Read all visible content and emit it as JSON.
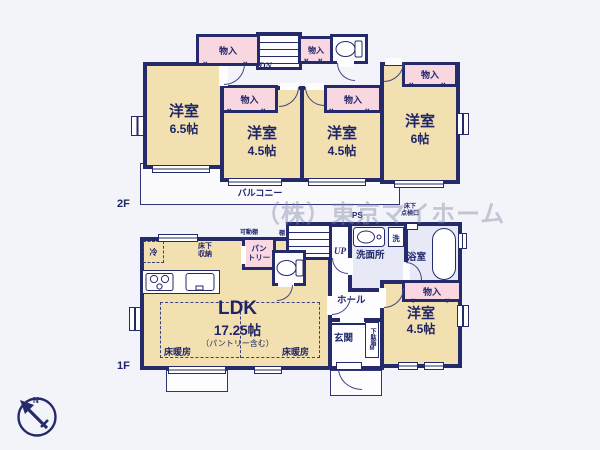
{
  "watermark": "（株）東京マイホーム",
  "compass": {
    "north": "N"
  },
  "icons": {
    "fold_mark": "∨"
  },
  "floor2": {
    "label": "2F",
    "balcony": "バルコニー",
    "stairs": "DN",
    "closet": "物入",
    "rooms": [
      {
        "name": "洋室",
        "size": "6.5帖"
      },
      {
        "name": "洋室",
        "size": "4.5帖"
      },
      {
        "name": "洋室",
        "size": "4.5帖"
      },
      {
        "name": "洋室",
        "size": "6帖"
      }
    ]
  },
  "floor1": {
    "label": "1F",
    "stairs": "UP",
    "ps": "PS",
    "closet": "物入",
    "ldk": {
      "name": "LDK",
      "size": "17.25帖",
      "note": "（パントリー含む）"
    },
    "floor_heating": "床暖房",
    "fridge": "冷",
    "underfloor_storage": "床下\n収納",
    "movable_shelf": "可動棚",
    "shelf": "棚",
    "pantry": "パン\nトリー",
    "underfloor_access": "床下\n点検口",
    "washroom": "洗面所",
    "washer": "洗",
    "bathroom": "浴室",
    "hall": "ホール",
    "entrance": "玄関",
    "shoe_cabinet": "下駄箱M",
    "bedroom": {
      "name": "洋室",
      "size": "4.5帖"
    }
  }
}
